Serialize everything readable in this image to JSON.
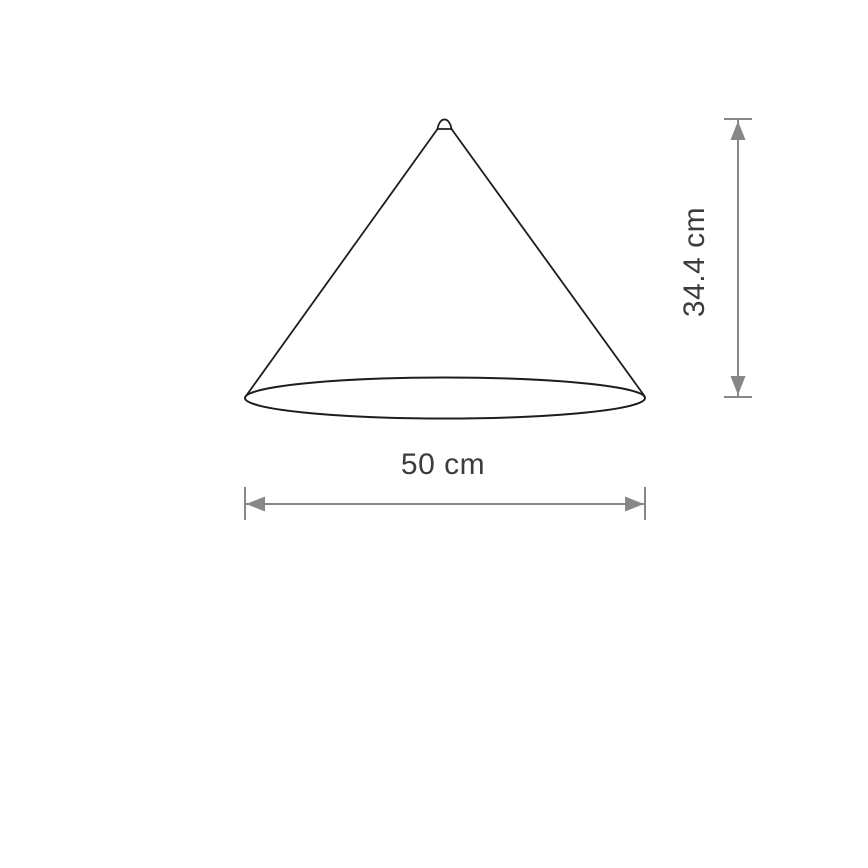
{
  "diagram": {
    "labels": {
      "width": "50 cm",
      "height": "34.4 cm"
    },
    "colors": {
      "outline": "#1d1d1b",
      "dimension": "#878787",
      "text": "#3c3c3b",
      "background": "#ffffff"
    }
  }
}
